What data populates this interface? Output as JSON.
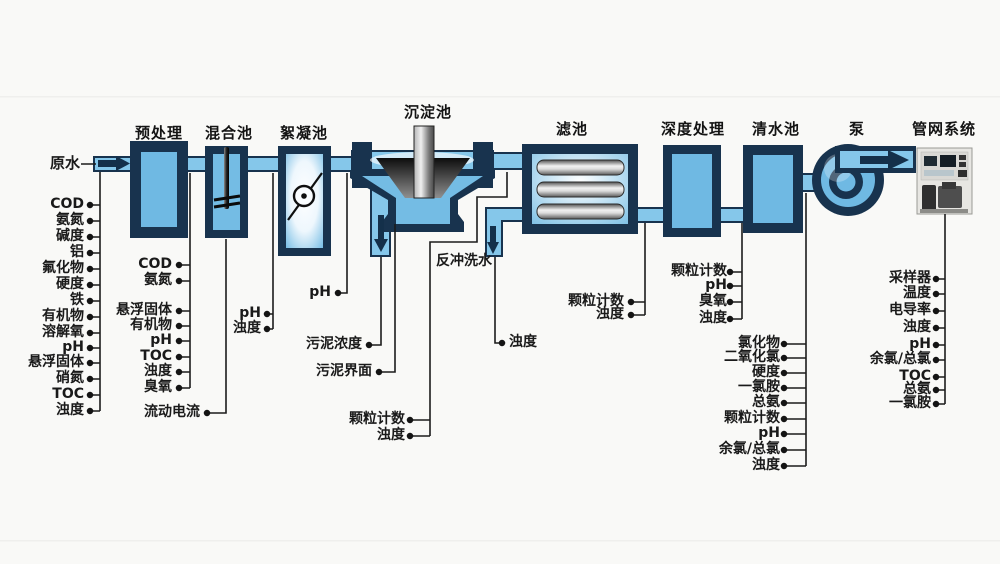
{
  "source": {
    "label": "原水"
  },
  "stages": {
    "pretreatment": "预处理",
    "mixing": "混合池",
    "flocculation": "絮凝池",
    "sedimentation": "沉淀池",
    "filter": "滤池",
    "advanced": "深度处理",
    "clearwater": "清水池",
    "pump": "泵",
    "network": "管网系统"
  },
  "annotations": {
    "backwash": "反冲洗水"
  },
  "monitoring": {
    "raw_water": [
      "COD",
      "氨氮",
      "碱度",
      "铝",
      "氟化物",
      "硬度",
      "铁",
      "有机物",
      "溶解氧",
      "pH",
      "悬浮固体",
      "硝氮",
      "TOC",
      "浊度"
    ],
    "after_pretreatment": [
      "COD",
      "氨氮",
      "悬浮固体",
      "有机物",
      "pH",
      "TOC",
      "浊度",
      "臭氧"
    ],
    "mixing_tank": [
      "流动电流"
    ],
    "after_mixing": [
      "pH",
      "浊度"
    ],
    "sedimentation_inlet": [
      "pH"
    ],
    "sludge": [
      "污泥浓度",
      "污泥界面"
    ],
    "settled_water": [
      "颗粒计数",
      "浊度"
    ],
    "filter_backwash": [
      "浊度"
    ],
    "after_filter": [
      "颗粒计数",
      "浊度"
    ],
    "after_advanced": [
      "颗粒计数",
      "pH",
      "臭氧",
      "浊度"
    ],
    "after_clearwater": [
      "氯化物",
      "二氧化氯",
      "硬度",
      "一氯胺",
      "总氨",
      "颗粒计数",
      "pH",
      "余氯/总氯",
      "浊度"
    ],
    "pipe_network": [
      "采样器",
      "温度",
      "电导率",
      "浊度",
      "pH",
      "余氯/总氯",
      "TOC",
      "总氨",
      "一氯胺"
    ]
  },
  "colors": {
    "tank_border": "#18334e",
    "tank_fill": "#6fb9e3",
    "pipe_fill": "#85c7ea",
    "connector": "#1c1c1c",
    "background": "#f9f9f7"
  }
}
